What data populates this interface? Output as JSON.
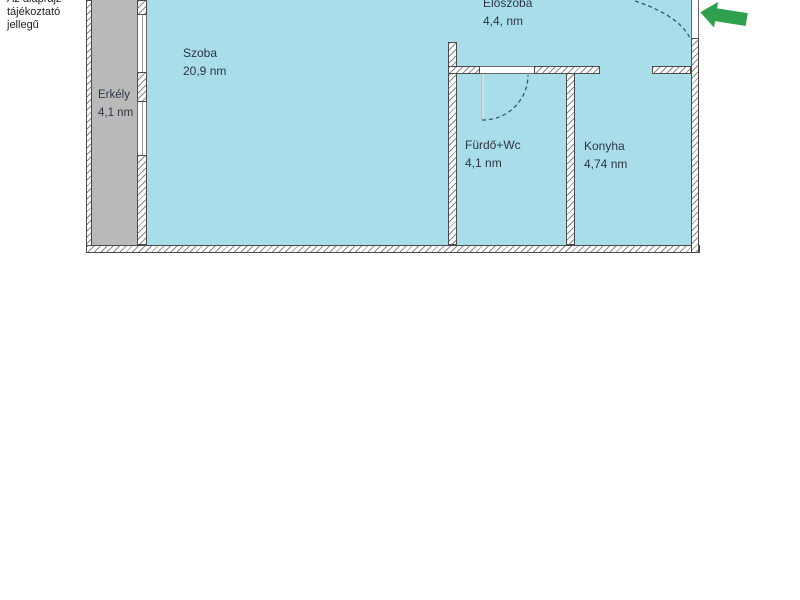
{
  "title": "apartment-floor-plan",
  "disclaimer": {
    "lines": [
      "Az alaprajz",
      "tájékoztató",
      "jellegű"
    ]
  },
  "rooms": [
    {
      "id": "szoba",
      "name": "Szoba",
      "area": "20,9 nm"
    },
    {
      "id": "erkely",
      "name": "Erkély",
      "area": "4,1 nm"
    },
    {
      "id": "eloszoba",
      "name": "Előszoba",
      "area": "4,4, nm"
    },
    {
      "id": "furdo",
      "name": "Fürdő+Wc",
      "area": "4,1 nm"
    },
    {
      "id": "konyha",
      "name": "Konyha",
      "area": "4,74 nm"
    }
  ],
  "icons": {
    "entrance_arrow": "left-arrow"
  },
  "colors": {
    "room_fill": "#a9dde9",
    "balcony_fill": "#b9b9b9",
    "wall_outline": "#4a4a4a",
    "door_swing": "#33566b",
    "arrow_green": "#2fa14e",
    "text": "#2c3744"
  }
}
